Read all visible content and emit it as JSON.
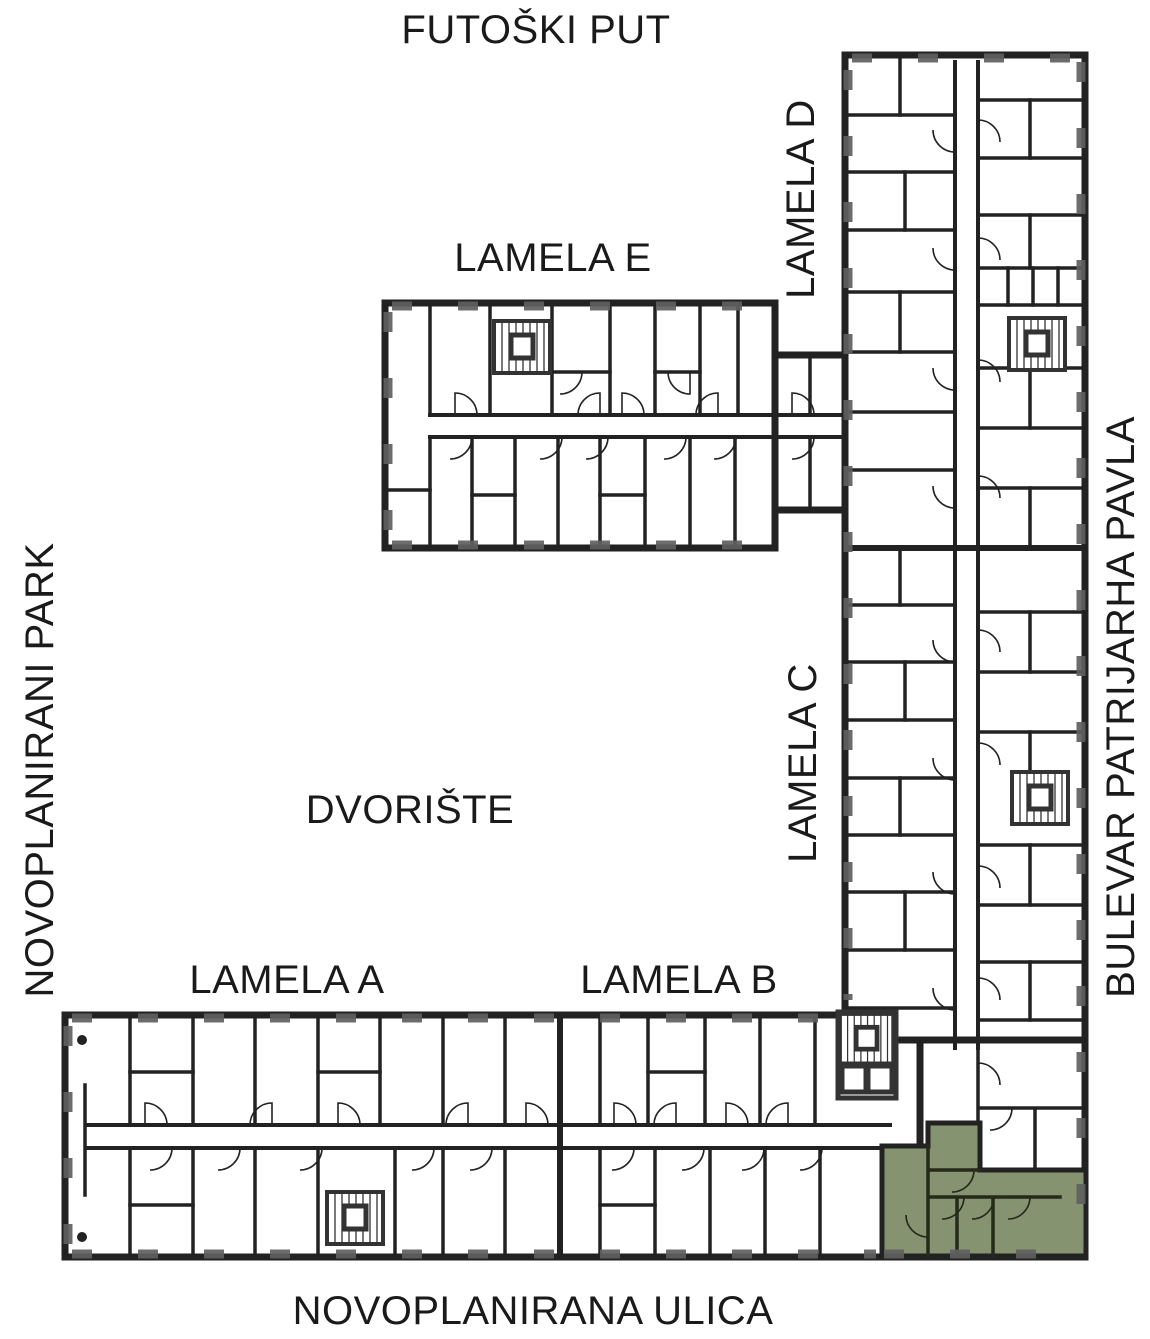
{
  "labels": {
    "street_top": "FUTOŠKI PUT",
    "street_left": "NOVOPLANIRANI PARK",
    "street_right": "BULEVAR PATRIJARHA PAVLA",
    "street_bottom": "NOVOPLANIRANA ULICA",
    "courtyard": "DVORIŠTE",
    "lamela_a": "LAMELA A",
    "lamela_b": "LAMELA B",
    "lamela_c": "LAMELA C",
    "lamela_d": "LAMELA D",
    "lamela_e": "LAMELA E"
  },
  "colors": {
    "background": "#ffffff",
    "wall": "#222222",
    "wall_light": "#5f5f5f",
    "unit_fill": "#859371",
    "unit_wall": "#242b1a",
    "text": "#1a1a1a"
  }
}
